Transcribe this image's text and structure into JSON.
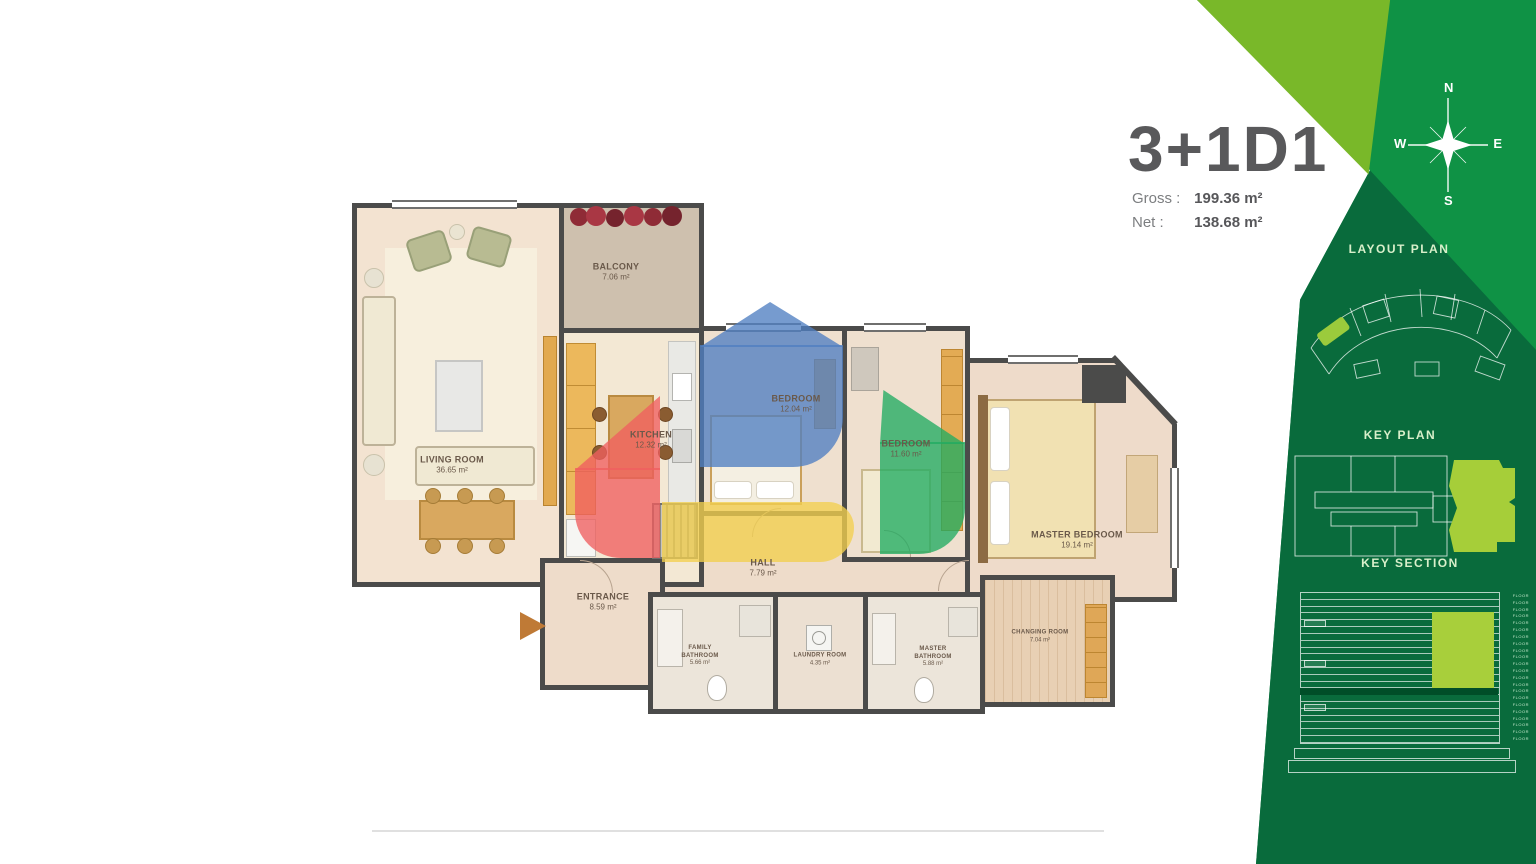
{
  "title": "3+1D1",
  "stats": {
    "gross_label": "Gross :",
    "gross_value": "199.36 m²",
    "net_label": "Net :",
    "net_value": "138.68 m²"
  },
  "compass": {
    "north": "N",
    "south": "S",
    "east": "E",
    "west": "W"
  },
  "panels": {
    "layout_plan_title": "LAYOUT PLAN",
    "key_plan_title": "KEY PLAN",
    "key_section_title": "KEY SECTION"
  },
  "key_section": {
    "floor_count": 22,
    "floor_label": "FLOOR"
  },
  "rooms": {
    "living": {
      "name": "LIVING ROOM",
      "area": "36.65 m²"
    },
    "balcony": {
      "name": "BALCONY",
      "area": "7.06 m²"
    },
    "kitchen": {
      "name": "KITCHEN",
      "area": "12.32 m²"
    },
    "bedroom1": {
      "name": "BEDROOM",
      "area": "12.04 m²"
    },
    "bedroom2": {
      "name": "BEDROOM",
      "area": "11.60 m²"
    },
    "master": {
      "name": "MASTER BEDROOM",
      "area": "19.14 m²"
    },
    "hall": {
      "name": "HALL",
      "area": "7.79 m²"
    },
    "entrance": {
      "name": "ENTRANCE",
      "area": "8.59 m²"
    },
    "family_bathroom": {
      "name": "FAMILY BATHROOM",
      "area": "5.66 m²"
    },
    "laundry": {
      "name": "LAUNDRY ROOM",
      "area": "4.35 m²"
    },
    "master_bathroom": {
      "name": "MASTER BATHROOM",
      "area": "5.88 m²"
    },
    "changing": {
      "name": "CHANGING ROOM",
      "area": "7.04 m²"
    }
  },
  "colors": {
    "lime": "#79b829",
    "green_mid": "#0f9245",
    "green_dark": "#096b3c",
    "overlay_blue": "#4f7fc2",
    "overlay_red": "#ef5f5f",
    "overlay_yellow": "#f2cf4e",
    "overlay_green": "#21ac62",
    "wall": "#4b4b4a"
  }
}
